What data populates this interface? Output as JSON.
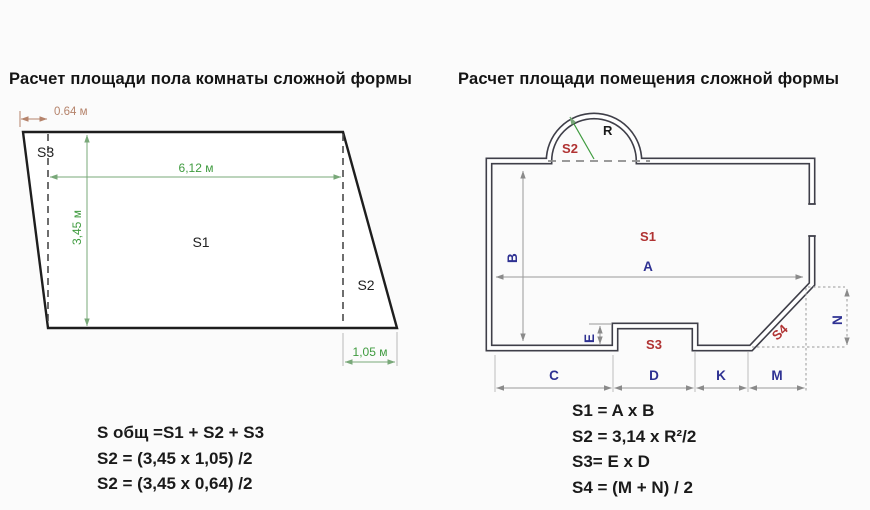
{
  "left": {
    "title": "Расчет площади пола комнаты сложной формы",
    "labels": {
      "s1": "S1",
      "s2": "S2",
      "s3": "S3"
    },
    "dims": {
      "offset_top": "0.64 м",
      "width": "6,12 м",
      "height": "3,45 м",
      "offset_bottom": "1,05 м"
    },
    "formulas": [
      "S общ =S1 + S2 + S3",
      "S2 = (3,45 x 1,05) /2",
      "S2 = (3,45 x 0,64) /2"
    ]
  },
  "right": {
    "title": "Расчет площади помещения сложной формы",
    "labels": {
      "s1": "S1",
      "s2": "S2",
      "s3": "S3",
      "s4": "S4",
      "radius": "R"
    },
    "dims": {
      "a": "A",
      "b": "B",
      "c": "C",
      "d": "D",
      "k": "K",
      "m": "M",
      "n": "N",
      "e": "E"
    },
    "formulas": [
      "S1 = A x B",
      "S2 = 3,14 x R²/2",
      "S3= E x D",
      "S4 = (M + N) / 2"
    ]
  },
  "colors": {
    "area_label_red": "#b03232",
    "dim_letter_navy": "#2e3192",
    "dim_green": "#3f9b3f",
    "dim_terracotta": "#b5836b",
    "wall_dark": "#3f3f49",
    "dim_gray": "#8a8a8a",
    "background": "#fbfbfb"
  }
}
